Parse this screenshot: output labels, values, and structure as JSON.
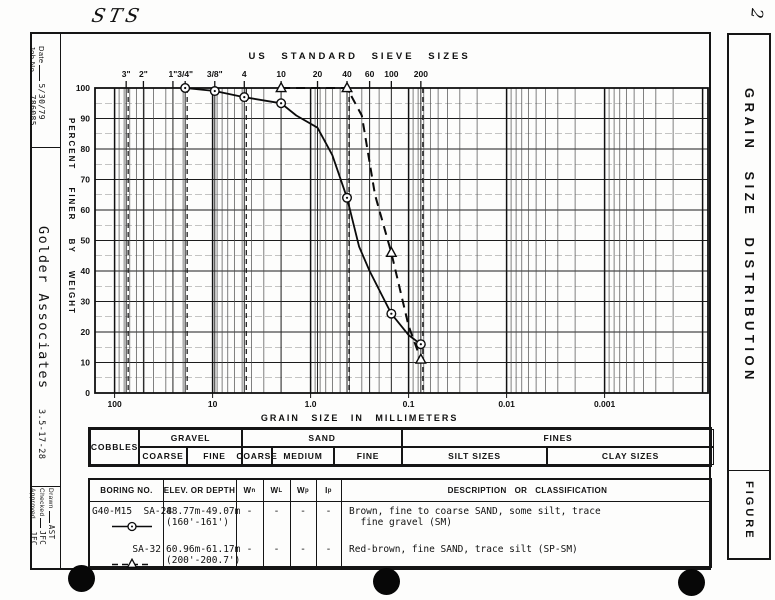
{
  "page": {
    "background": "#fdfdfc",
    "ink": "#111111"
  },
  "annotations": {
    "top_left_handwriting": "STS",
    "top_right_handwriting": "2"
  },
  "titleblock": {
    "date_label": "Date",
    "date_value": "5/30/79",
    "job_label": "Job No.",
    "job_value": "786085",
    "company": "Golder  Associates",
    "company_code": "3.5-17-28",
    "drawn_label": "Drawn",
    "drawn_value": "AST",
    "checked_label": "Checked",
    "checked_value": "JFC",
    "approved_label": "Approved",
    "approved_value": "JFC"
  },
  "sidebar_right": {
    "title": "GRAIN SIZE DISTRIBUTION",
    "figure_label": "FIGURE"
  },
  "chart_data": {
    "type": "line",
    "title": "US STANDARD SIEVE SIZES",
    "xlabel": "GRAIN SIZE IN MILLIMETERS",
    "ylabel": "PERCENT FINER BY WEIGHT",
    "x_scale": "log",
    "x_axis_unit": "mm",
    "xlim": [
      160,
      0.0003
    ],
    "ylim": [
      0,
      100
    ],
    "grid": true,
    "y_ticks": [
      100,
      90,
      80,
      70,
      60,
      50,
      40,
      30,
      20,
      10,
      0
    ],
    "x_decades": [
      {
        "label": "100",
        "mm": 100
      },
      {
        "label": "10",
        "mm": 10
      },
      {
        "label": "1.0",
        "mm": 1.0
      },
      {
        "label": "0.1",
        "mm": 0.1
      },
      {
        "label": "0.01",
        "mm": 0.01
      },
      {
        "label": "0.001",
        "mm": 0.001
      }
    ],
    "sieve_ticks": [
      {
        "label": "3\"",
        "mm": 76.2
      },
      {
        "label": "2\"",
        "mm": 50.8
      },
      {
        "label": "1\"",
        "mm": 25.4
      },
      {
        "label": "3/4\"",
        "mm": 19.05
      },
      {
        "label": "3/8\"",
        "mm": 9.5
      },
      {
        "label": "4",
        "mm": 4.75
      },
      {
        "label": "10",
        "mm": 2.0
      },
      {
        "label": "20",
        "mm": 0.85
      },
      {
        "label": "40",
        "mm": 0.425
      },
      {
        "label": "60",
        "mm": 0.25
      },
      {
        "label": "100",
        "mm": 0.15
      },
      {
        "label": "200",
        "mm": 0.075
      }
    ],
    "boundary_lines_mm": [
      76.2,
      19.05,
      4.75,
      0.425,
      0.075
    ],
    "series": [
      {
        "name": "G40-M15 SA-28",
        "marker": "circle",
        "line_style": "solid",
        "curve_mm_percent": [
          [
            19.05,
            100
          ],
          [
            9.5,
            99
          ],
          [
            4.75,
            97
          ],
          [
            2.0,
            95
          ],
          [
            1.4,
            91
          ],
          [
            0.85,
            87
          ],
          [
            0.6,
            78
          ],
          [
            0.425,
            64
          ],
          [
            0.32,
            48
          ],
          [
            0.25,
            40
          ],
          [
            0.15,
            26
          ],
          [
            0.1,
            19
          ],
          [
            0.075,
            16
          ]
        ],
        "marker_mm_percent": [
          [
            19.05,
            100
          ],
          [
            9.5,
            99
          ],
          [
            4.75,
            97
          ],
          [
            2.0,
            95
          ],
          [
            0.425,
            64
          ],
          [
            0.15,
            26
          ],
          [
            0.075,
            16
          ]
        ]
      },
      {
        "name": "SA-32",
        "marker": "triangle",
        "line_style": "dashed",
        "curve_mm_percent": [
          [
            2.0,
            100
          ],
          [
            0.425,
            100
          ],
          [
            0.3,
            91
          ],
          [
            0.22,
            65
          ],
          [
            0.15,
            46
          ],
          [
            0.1,
            22
          ],
          [
            0.075,
            11
          ]
        ],
        "marker_mm_percent": [
          [
            2.0,
            100
          ],
          [
            0.425,
            100
          ],
          [
            0.15,
            46
          ],
          [
            0.075,
            11
          ]
        ]
      }
    ]
  },
  "classification": {
    "col_widths": [
      49,
      48,
      55,
      30,
      62,
      68,
      145,
      167
    ],
    "groups": [
      {
        "label": "COBBLES",
        "from": 0,
        "to": 1,
        "full_height": true
      },
      {
        "label": "GRAVEL",
        "from": 1,
        "to": 3
      },
      {
        "label": "SAND",
        "from": 3,
        "to": 6
      },
      {
        "label": "FINES",
        "from": 6,
        "to": 8
      }
    ],
    "subs": [
      "",
      "COARSE",
      "FINE",
      "COARSE",
      "MEDIUM",
      "FINE",
      "SILT SIZES",
      "CLAY SIZES"
    ]
  },
  "table": {
    "col_widths": [
      73,
      73,
      27,
      27,
      26,
      25,
      373
    ],
    "headers": [
      {
        "t": "BORING NO."
      },
      {
        "t": "ELEV. OR DEPTH"
      },
      {
        "t": "W",
        "sub": "n"
      },
      {
        "t": "W",
        "sub": "L"
      },
      {
        "t": "W",
        "sub": "p"
      },
      {
        "t": "I",
        "sub": "p"
      },
      {
        "t": "DESCRIPTION   OR   CLASSIFICATION"
      }
    ],
    "rows": [
      {
        "boring": "G40-M15  SA-28",
        "symbol": "circle-solid",
        "elev_lines": [
          "48.77m-49.07m",
          "(160'-161')"
        ],
        "wn": "-",
        "wl": "-",
        "wp": "-",
        "ip": "-",
        "desc_lines": [
          "Brown, fine to coarse SAND, some silt, trace",
          "  fine gravel (SM)"
        ]
      },
      {
        "boring": "SA-32",
        "symbol": "triangle-dashed",
        "elev_lines": [
          "60.96m-61.17m",
          "(200'-200.7')"
        ],
        "wn": "-",
        "wl": "-",
        "wp": "-",
        "ip": "-",
        "desc_lines": [
          "Red-brown, fine SAND, trace silt (SP-SM)"
        ]
      }
    ]
  }
}
